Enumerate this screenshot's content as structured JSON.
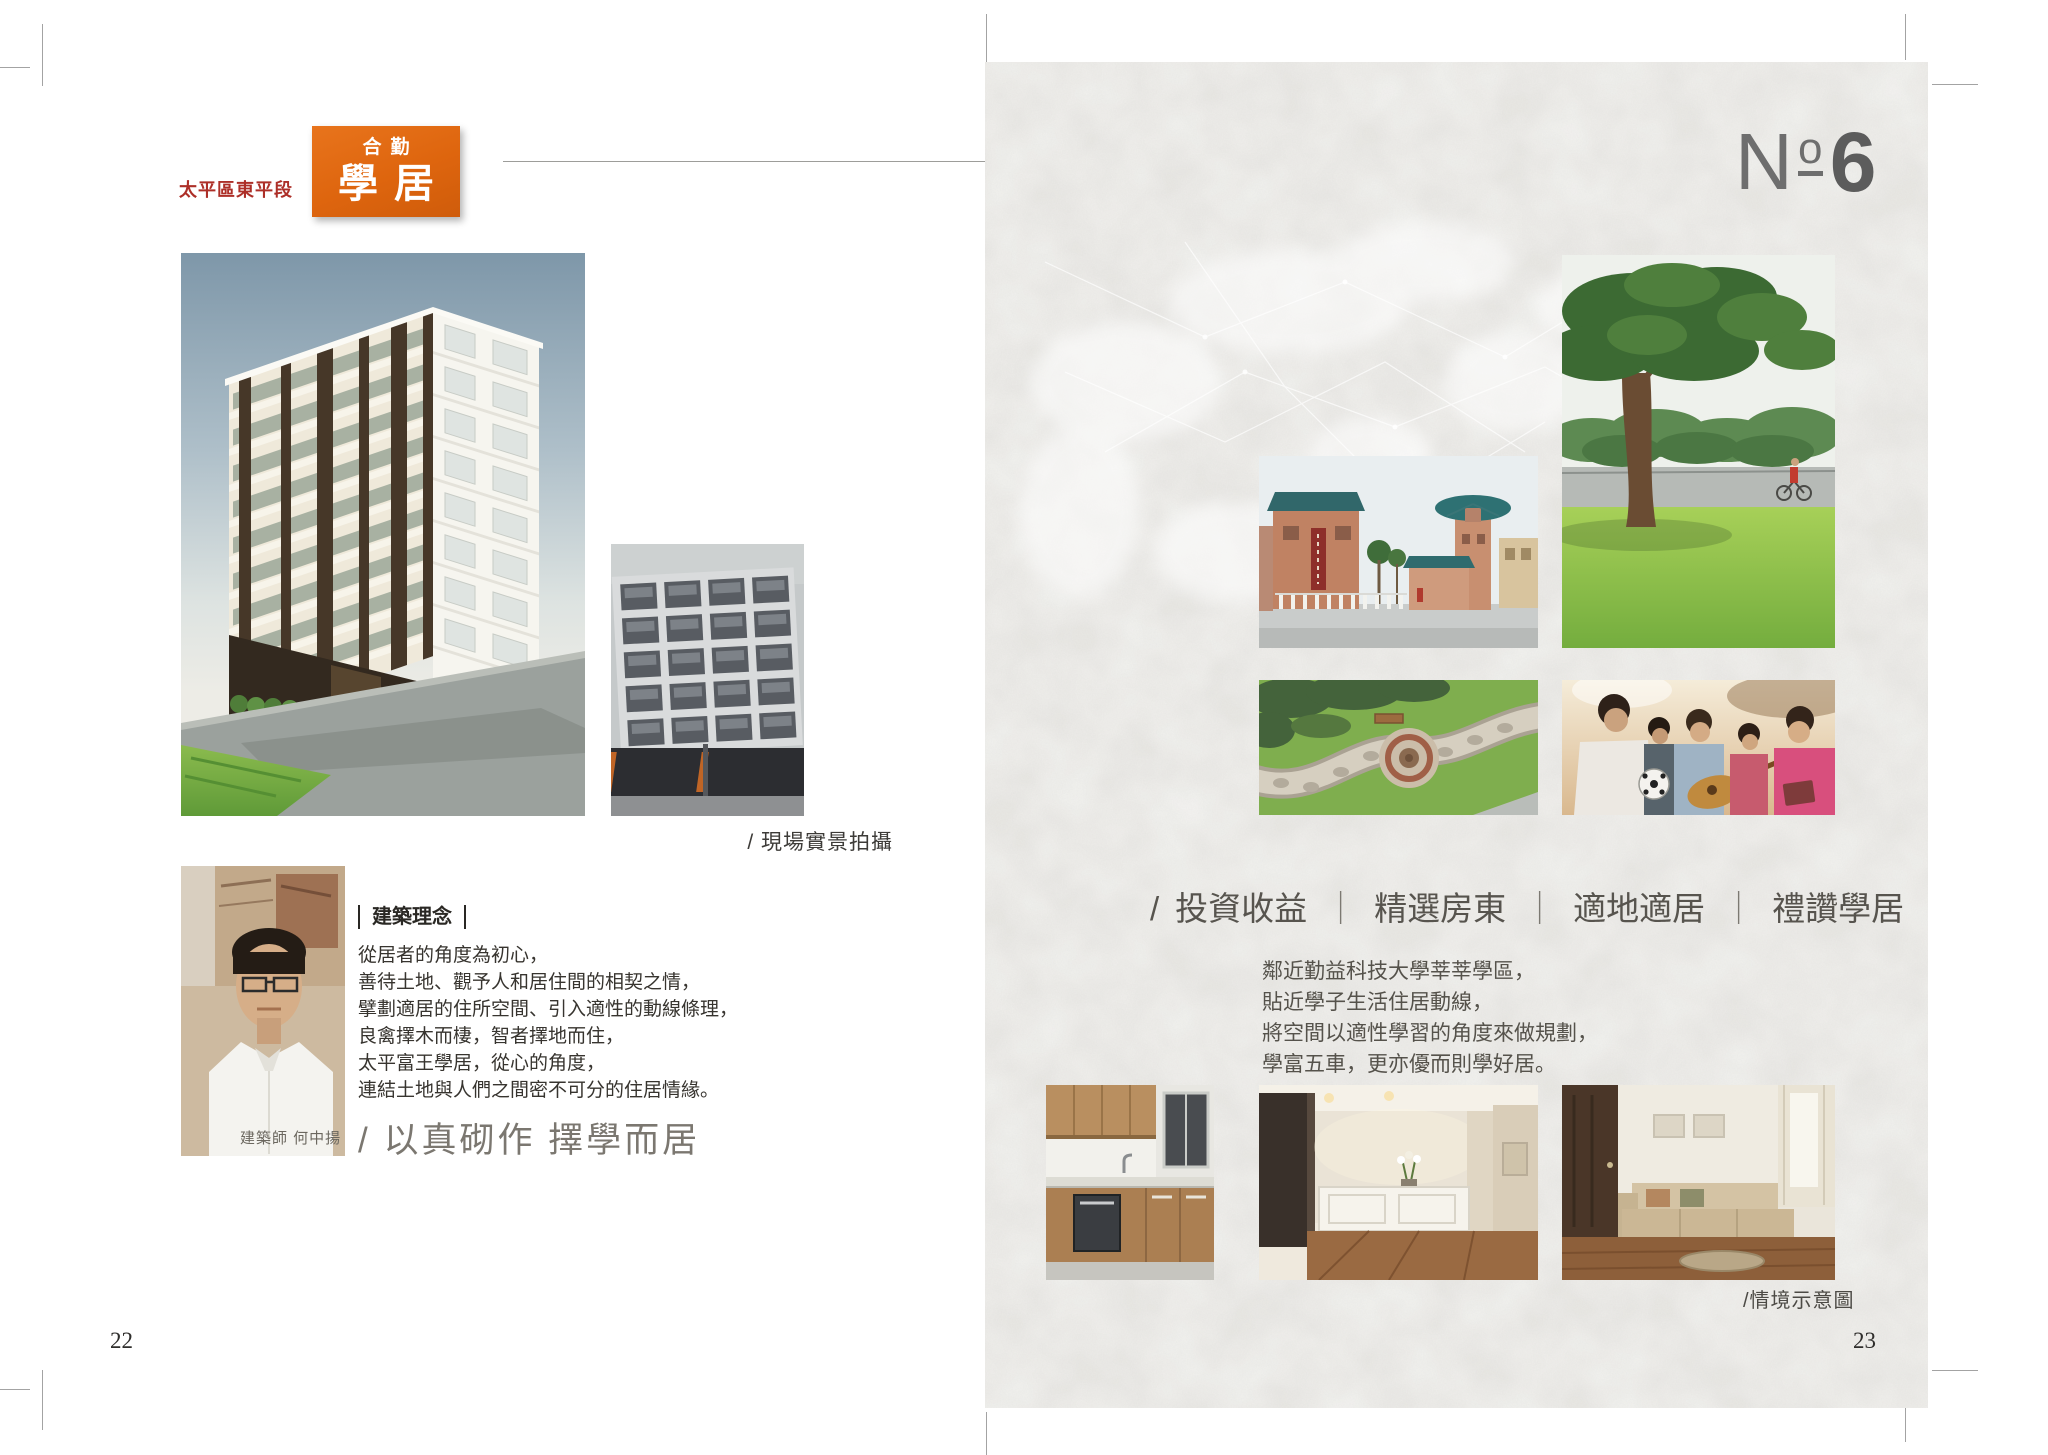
{
  "colors": {
    "badge_orange": "#de650e",
    "location_red": "#ad2f28",
    "paper_gray": "#e8e7e3",
    "headline_gray": "#57544e",
    "slogan_gray": "#7b7770"
  },
  "left_page": {
    "page_number": "22",
    "location_label": "太平區東平段",
    "badge": {
      "line1": "合勤",
      "line2": "學居"
    },
    "site_photo_caption": "/ 現場實景拍攝",
    "philosophy_heading": "建築理念",
    "philosophy_lines": [
      "從居者的角度為初心，",
      "善待土地、觀予人和居住間的相契之情，",
      "擘劃適居的住所空間、引入適性的動線條理，",
      "良禽擇木而棲，智者擇地而住，",
      "太平富王學居，從心的角度，",
      "連結土地與人們之間密不可分的住居情緣。"
    ],
    "architect_caption": "建築師 何中揚",
    "slogan": "/ 以真砌作 擇學而居"
  },
  "right_page": {
    "page_number": "23",
    "issue_no": {
      "n": "N",
      "o": "o",
      "digit": "6"
    },
    "headline": {
      "prefix": "/",
      "separator": "｜",
      "segments": [
        "投資收益",
        "精選房東",
        "適地適居",
        "禮讚學居"
      ]
    },
    "body_lines": [
      "鄰近勤益科技大學莘莘學區，",
      "貼近學子生活住居動線，",
      "將空間以適性學習的角度來做規劃，",
      "學富五車，更亦優而則學好居。"
    ],
    "interior_caption": "/情境示意圖"
  }
}
